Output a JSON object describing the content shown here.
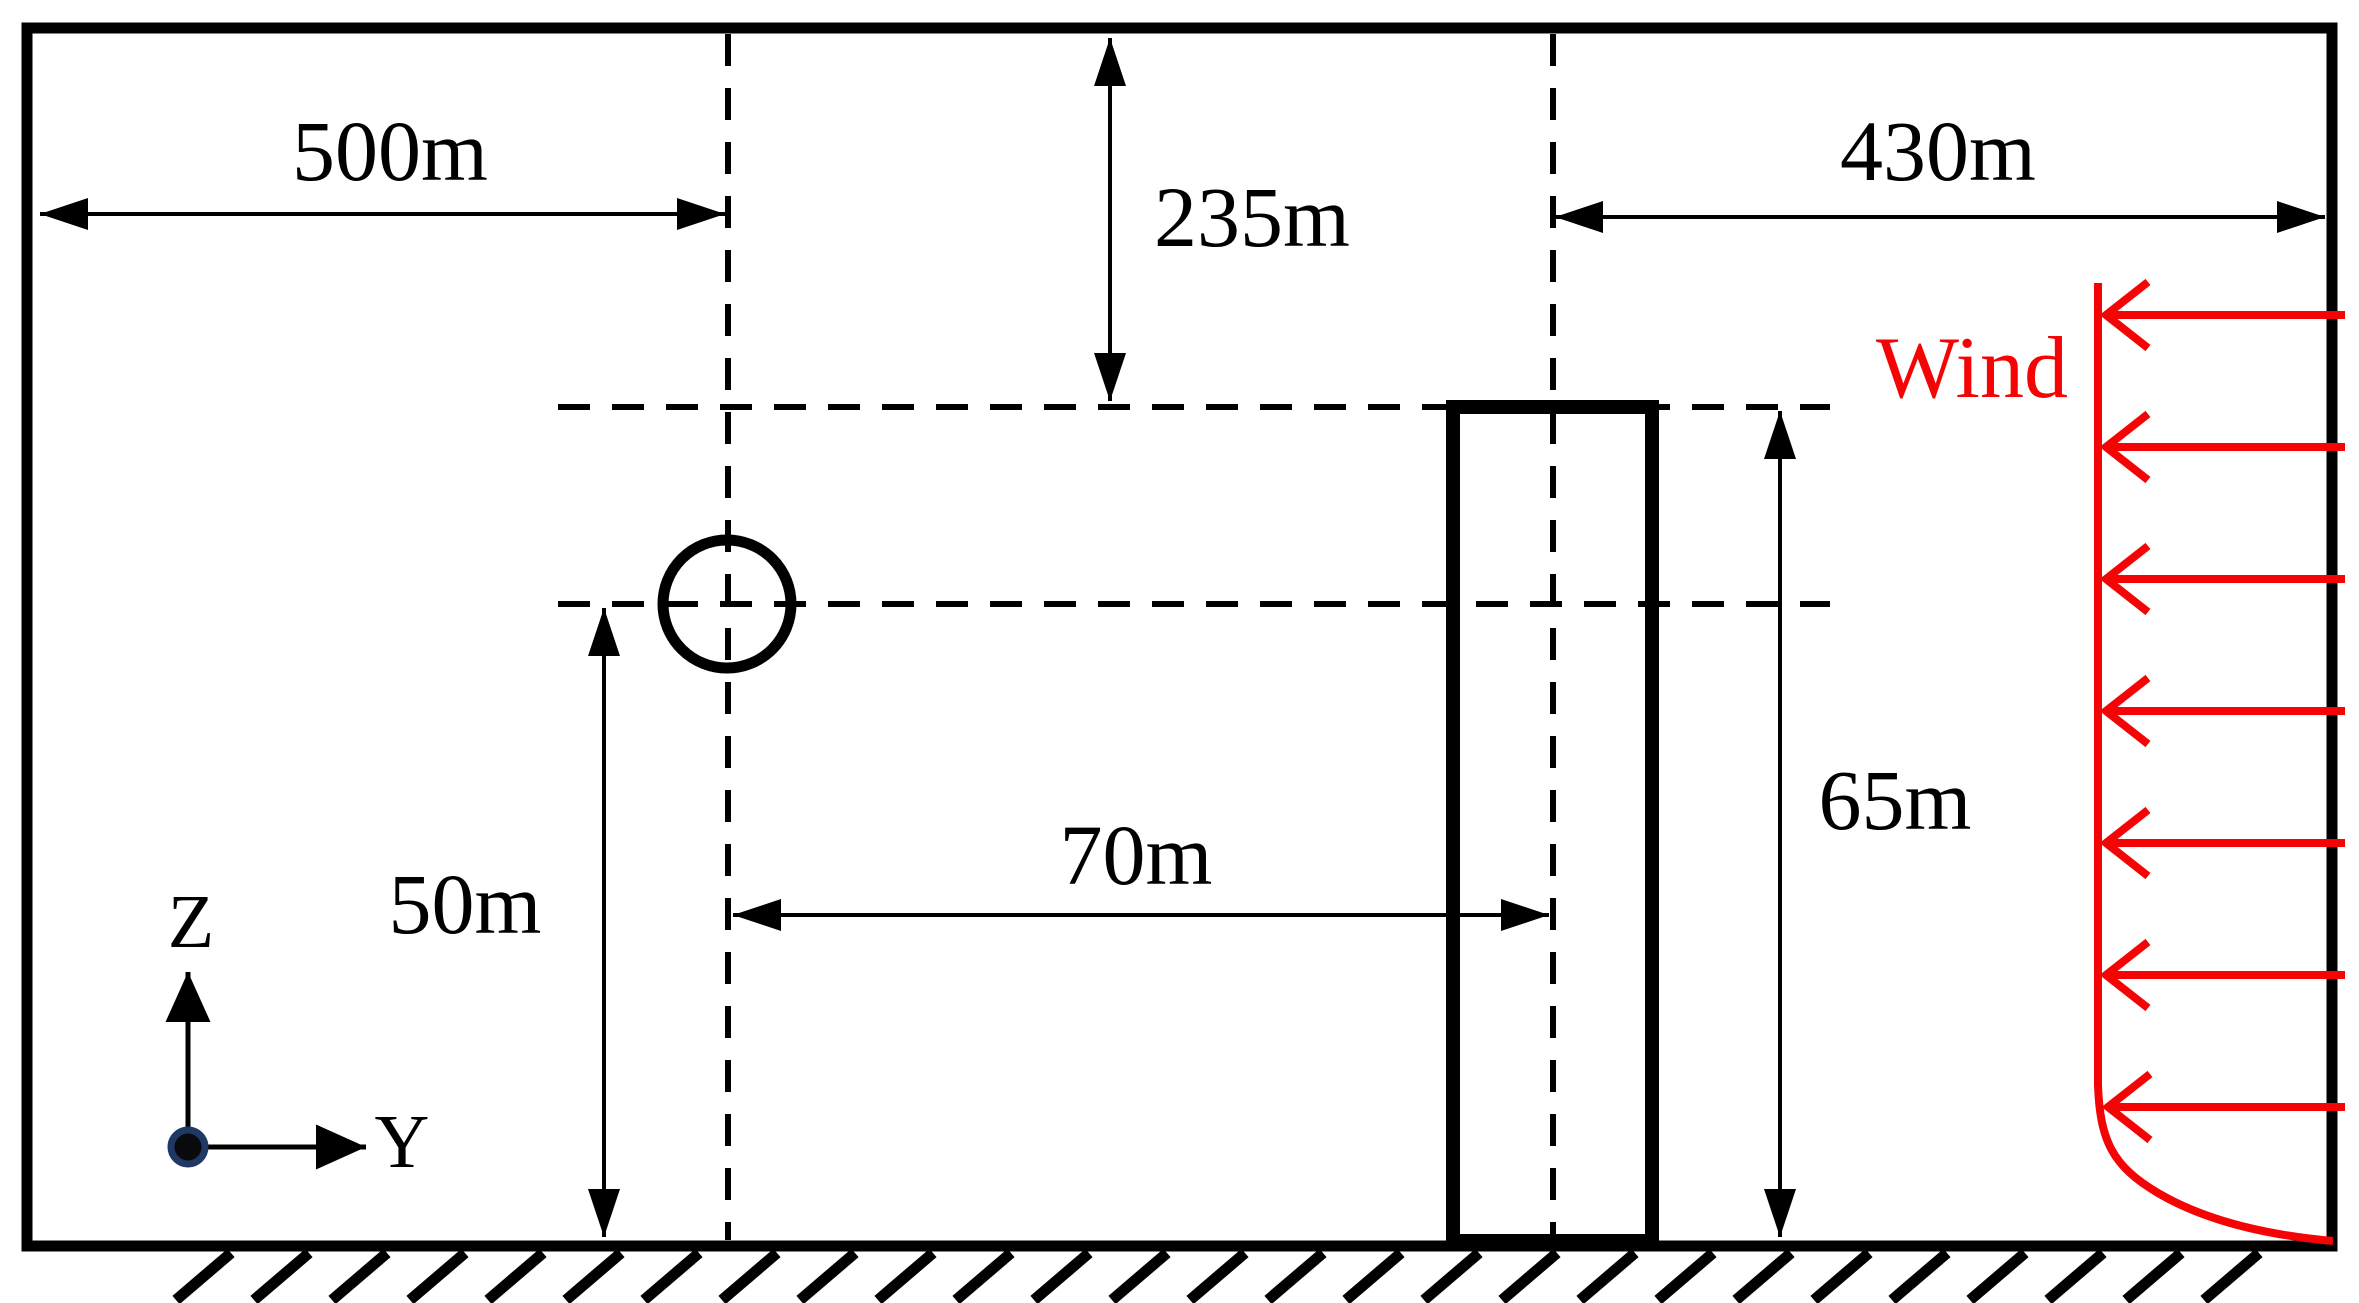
{
  "diagram": {
    "title": "wind-over-building computational domain schematic (side view)",
    "labels": {
      "d500": "500m",
      "d430": "430m",
      "d235": "235m",
      "d70": "70m",
      "d50": "50m",
      "d65": "65m"
    },
    "wind": {
      "label": "Wind",
      "direction": "right-to-left",
      "arrow_count": 7,
      "profile": "uniform above, boundary-layer curve near ground"
    },
    "axes": {
      "vertical": "Z",
      "horizontal": "Y"
    },
    "shapes": {
      "circle": "circular cross-section on upstream dashed centerline",
      "building": "tall rectangular building on ground",
      "ground": "hatched ground line under domain"
    },
    "colors": {
      "line": "#000000",
      "wind_red": "#f40404",
      "origin_dot_ring": "#1f3864",
      "background": "#ffffff"
    }
  }
}
